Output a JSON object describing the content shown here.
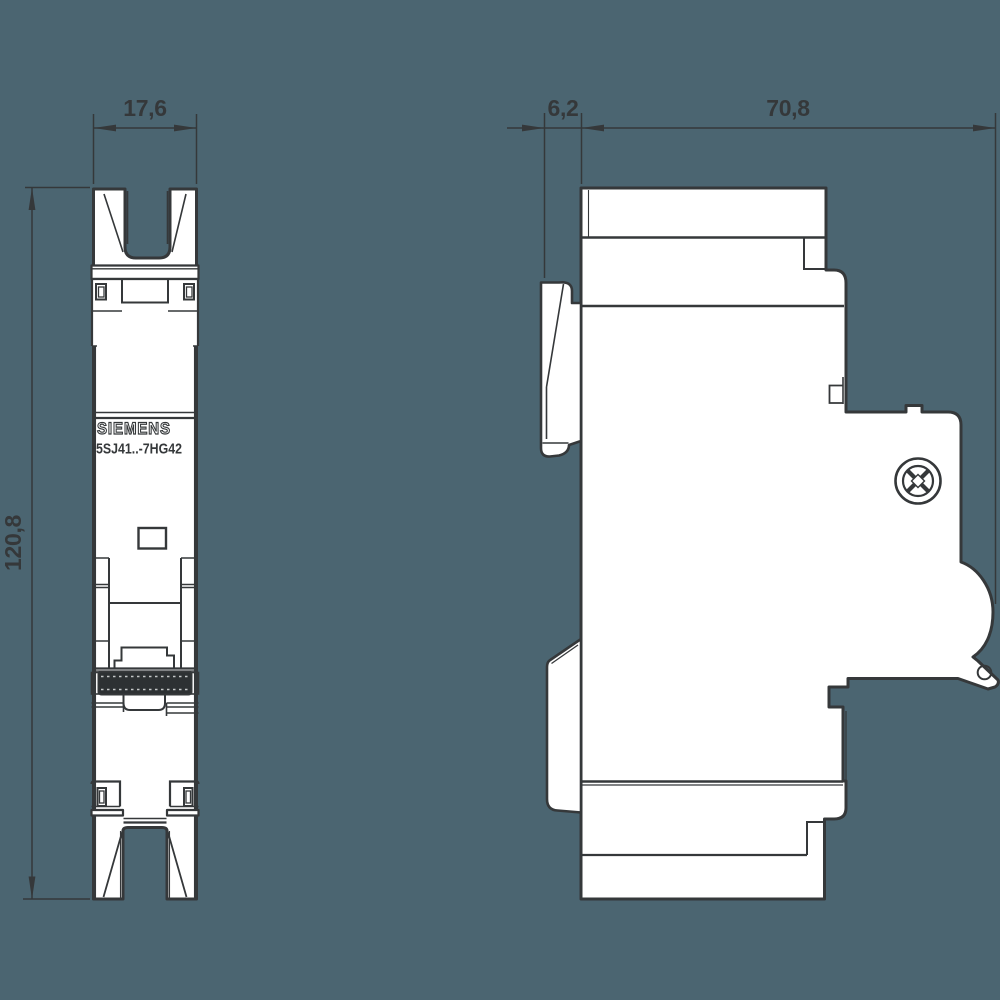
{
  "drawing_title": "Miniature circuit breaker dimension drawing",
  "colors": {
    "background": "#4b6571",
    "line": "#35383a",
    "body_fill": "#ffffff",
    "toggle_fill": "#2d3133"
  },
  "product": {
    "brand": "SIEMENS",
    "model": "5SJ41..-7HG42"
  },
  "dimensions": {
    "front_width": "17,6",
    "front_height": "120,8",
    "rail_offset": "6,2",
    "depth": "70,8"
  },
  "views": {
    "front": "front view",
    "side": "side view"
  }
}
